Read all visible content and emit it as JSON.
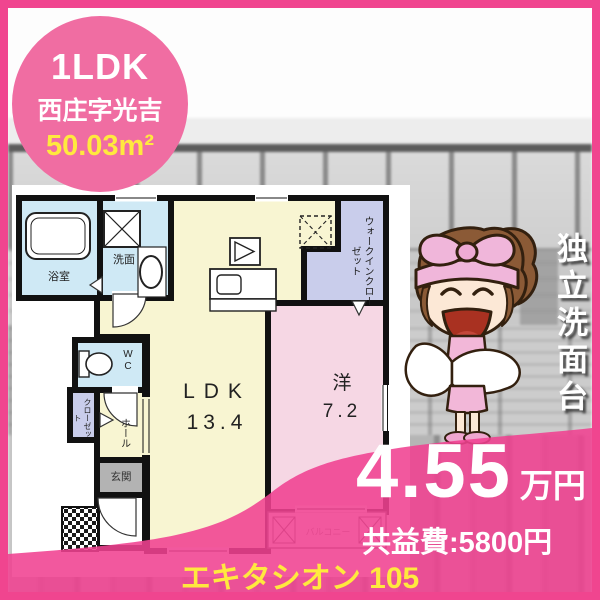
{
  "flyer": {
    "badge": {
      "layout_type": "1LDK",
      "address": "西庄字光吉",
      "area": "50.03m²"
    },
    "feature_banner": "独立洗面台",
    "price": {
      "rent_amount": "4.55",
      "rent_unit": "万円",
      "common_service_fee": "共益費:5800円"
    },
    "property_title": "エキタシオン 105",
    "floorplan": {
      "ldk_name": "LDK",
      "ldk_size": "13.4",
      "western_name": "洋",
      "western_size": "7.2",
      "bath": "浴室",
      "washroom": "洗面",
      "toilet": "WC",
      "closet": "クローゼット",
      "walk_in_closet": "ウォークインクローゼット",
      "hall": "ホール",
      "entrance": "玄関",
      "balcony": "バルコニー"
    },
    "colors": {
      "accent_pink": "#f0458f",
      "badge_pink": "#f06da2",
      "highlight_yellow": "#ffe93e",
      "room_yellow": "#f8f5d2",
      "room_blue": "#cfe9f5",
      "room_lavender": "#c9cdeb",
      "room_pink": "#f6d7e4",
      "entrance_gray": "#b3b3b3"
    }
  }
}
